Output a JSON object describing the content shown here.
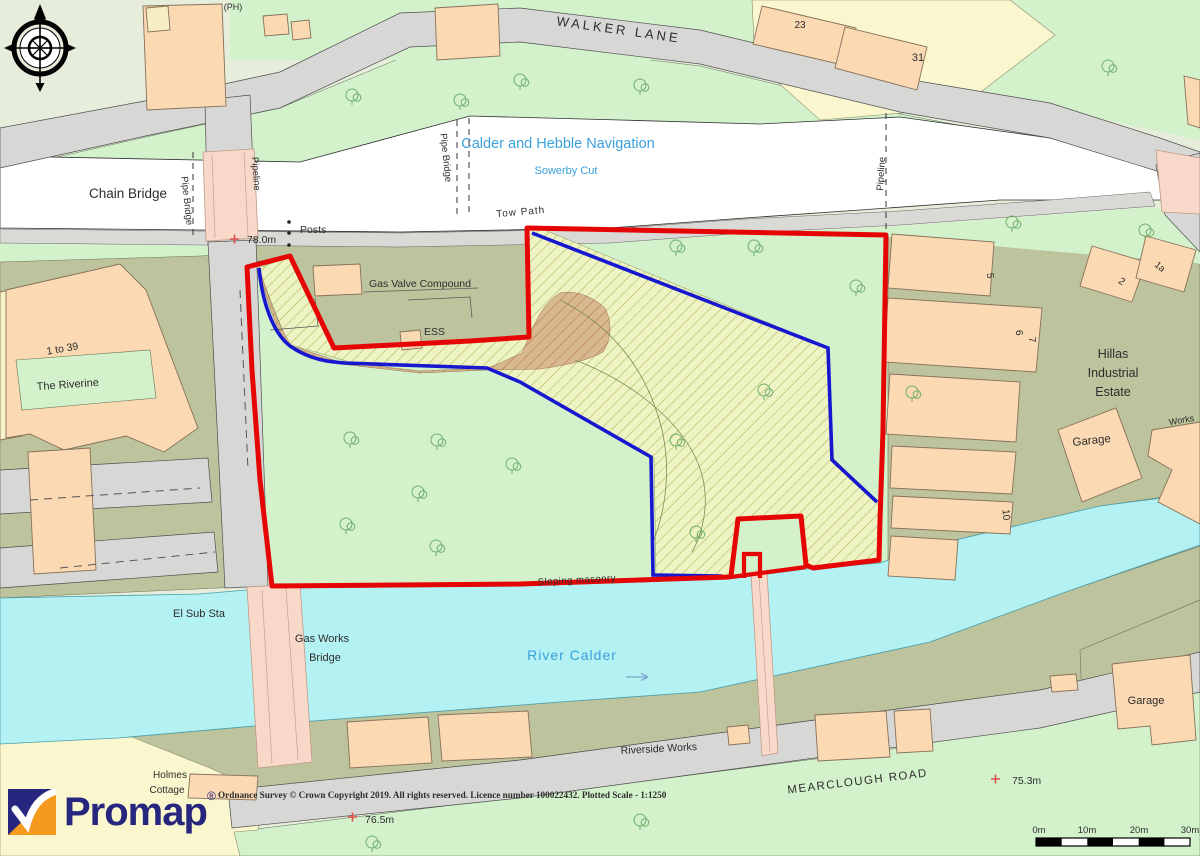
{
  "labels": [
    {
      "text": "(PH)"
    },
    {
      "text": "WALKER LANE"
    },
    {
      "text": "23"
    },
    {
      "text": "31"
    },
    {
      "text": "Chain Bridge"
    },
    {
      "text": "Pipe Bridge"
    },
    {
      "text": "Pipe Bridge"
    },
    {
      "text": "Pipeline"
    },
    {
      "text": "Pipeline"
    },
    {
      "text": "Calder and Hebble Navigation"
    },
    {
      "text": "Sowerby Cut"
    },
    {
      "text": "Tow Path"
    },
    {
      "text": "78.0m"
    },
    {
      "text": "Posts"
    },
    {
      "text": "Gas Valve Compound"
    },
    {
      "text": "ESS"
    },
    {
      "text": "1 to 39"
    },
    {
      "text": "The Riverine"
    },
    {
      "text": "Hillas"
    },
    {
      "text": "Industrial"
    },
    {
      "text": "Estate"
    },
    {
      "text": "Works"
    },
    {
      "text": "Garage"
    },
    {
      "text": "5"
    },
    {
      "text": "2"
    },
    {
      "text": "1a"
    },
    {
      "text": "6"
    },
    {
      "text": "7"
    },
    {
      "text": "10"
    },
    {
      "text": "El Sub Sta"
    },
    {
      "text": "Gas Works"
    },
    {
      "text": "Bridge"
    },
    {
      "text": "River Calder"
    },
    {
      "text": "Sloping masonry"
    },
    {
      "text": "Riverside Works"
    },
    {
      "text": "MEARCLOUGH ROAD"
    },
    {
      "text": "75.3m"
    },
    {
      "text": "76.5m"
    },
    {
      "text": "Holmes"
    },
    {
      "text": "Cottage"
    },
    {
      "text": "Garage"
    },
    {
      "text": "Ordnance Survey © Crown Copyright 2019. All rights reserved. Licence number 100022432. Plotted Scale -  1:1250"
    }
  ],
  "footer": {
    "brand": "Promap",
    "registered": "®"
  },
  "scalebar": {
    "ticks": [
      "0m",
      "10m",
      "20m",
      "30m"
    ]
  },
  "colors": {
    "boundary_red": "#e60505",
    "boundary_blue": "#1717cf",
    "river_water": "#b4f1f3",
    "canal_water": "#ffffff",
    "vegetation_green": "#d3f2cc",
    "khaki_ground": "#bdc39c",
    "building_salmon": "#fbd9b2",
    "road_grey": "#d7d7d5",
    "bridge_pink": "#f8d8c8",
    "hatch_brown": "#d8b88f",
    "hatch_yellow": "#eef3c3",
    "water_label_blue": "#3aa0dc",
    "spot_height_red": "#e05050",
    "brand_navy": "#26267e",
    "brand_orange": "#f49a1e"
  }
}
